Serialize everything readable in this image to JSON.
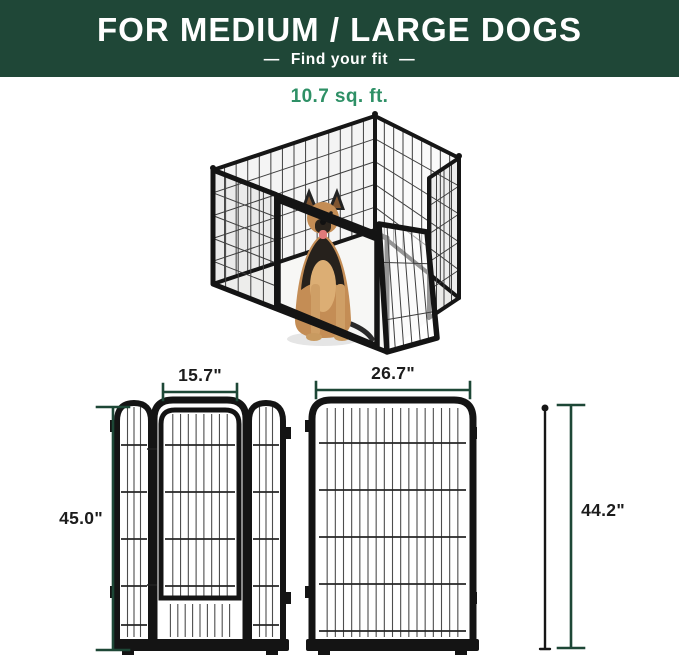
{
  "header": {
    "title": "FOR MEDIUM / LARGE DOGS",
    "dash_left": "—",
    "subtitle": "Find your fit",
    "dash_right": "—",
    "bg_color": "#1f4737",
    "text_color": "#ffffff"
  },
  "product": {
    "area_label": "10.7 sq. ft.",
    "area_label_color": "#2e9066"
  },
  "diagrams": {
    "dimension_line_color": "#1d4736",
    "door_panel": {
      "width_label": "15.7\"",
      "height_label": "45.0\""
    },
    "plain_panel": {
      "width_label": "26.7\""
    },
    "connecting_rod": {
      "height_label": "44.2\""
    }
  }
}
